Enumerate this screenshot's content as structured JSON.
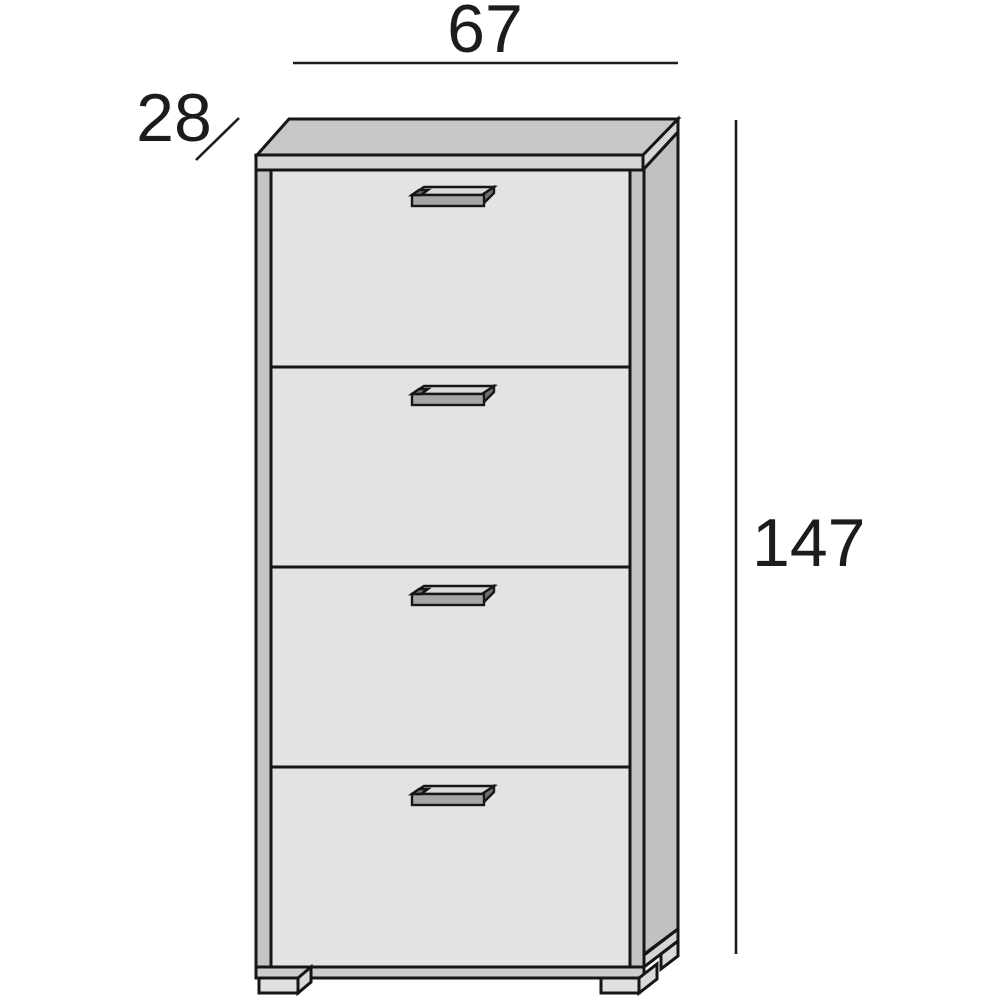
{
  "diagram": {
    "type": "furniture-dimension-drawing",
    "subject": "shoe cabinet with 4 drop-down flap doors",
    "dimensions": {
      "width": "67",
      "depth": "28",
      "height": "147"
    },
    "cabinet": {
      "flap_count": 4,
      "handle_count": 4,
      "front_feet_count": 2
    },
    "colors": {
      "outline": "#161616",
      "dimension_text": "#1c1c1c",
      "door_face": "#e3e3e3",
      "top_face": "#c7c7c7",
      "top_strip": "#d6d6d6",
      "side_panel": "#c1c1c1",
      "edge_stile": "#c4c4c4",
      "base_strip": "#cdcdcd",
      "base_strip_side": "#d6d6d6",
      "foot_face": "#e0e0e0",
      "foot_side": "#d9d9d9",
      "handle_bar": "#a5a5a5",
      "handle_top": "#d9d9d9",
      "handle_end": "#707070",
      "background": "#ffffff"
    }
  }
}
